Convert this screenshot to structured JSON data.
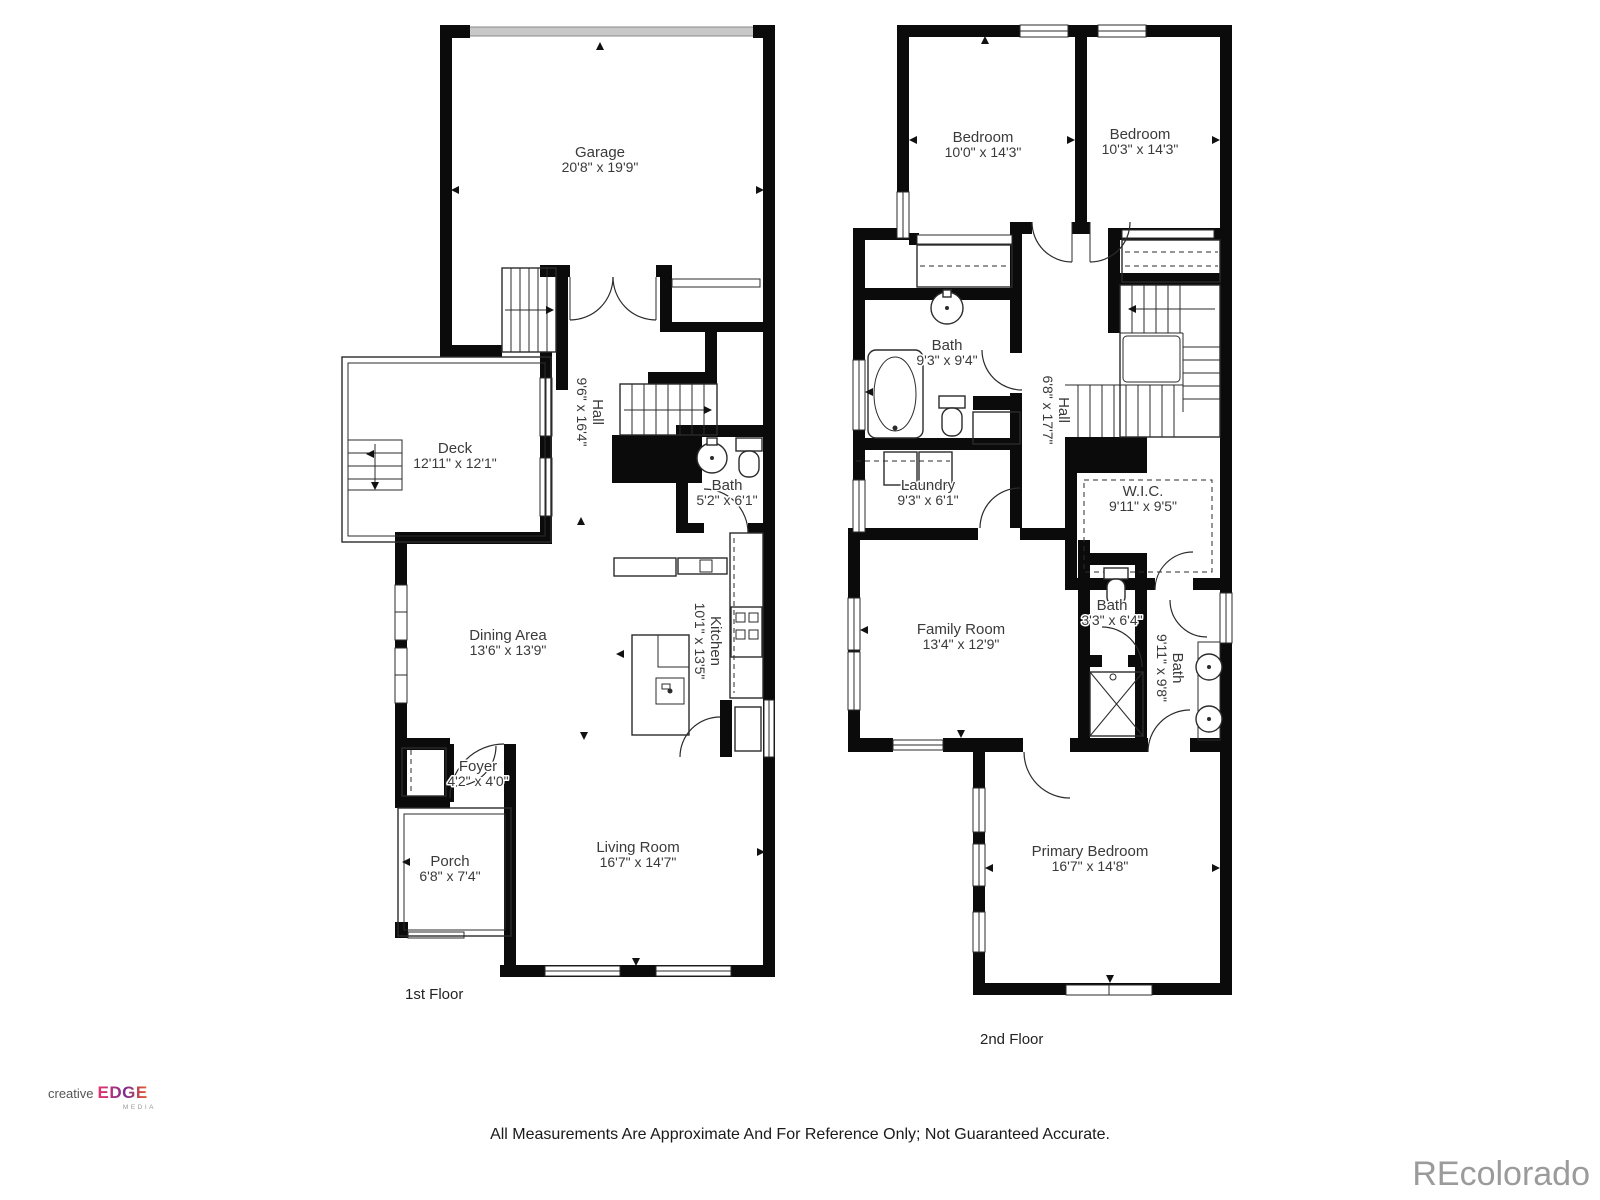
{
  "floors": [
    {
      "label": "1st Floor",
      "rooms": {
        "garage": {
          "name": "Garage",
          "dims": "20'8\" x 19'9\""
        },
        "hall": {
          "name": "Hall",
          "dims": "9'6\" x 16'4\""
        },
        "deck": {
          "name": "Deck",
          "dims": "12'11\" x 12'1\""
        },
        "bath": {
          "name": "Bath",
          "dims": "5'2\" x 6'1\""
        },
        "kitchen": {
          "name": "Kitchen",
          "dims": "10'1\" x 13'5\""
        },
        "dining": {
          "name": "Dining Area",
          "dims": "13'6\" x 13'9\""
        },
        "foyer": {
          "name": "Foyer",
          "dims": "4'2\" x 4'0\""
        },
        "porch": {
          "name": "Porch",
          "dims": "6'8\" x 7'4\""
        },
        "living": {
          "name": "Living Room",
          "dims": "16'7\" x 14'7\""
        }
      }
    },
    {
      "label": "2nd Floor",
      "rooms": {
        "bedroom_left": {
          "name": "Bedroom",
          "dims": "10'0\" x 14'3\""
        },
        "bedroom_right": {
          "name": "Bedroom",
          "dims": "10'3\" x 14'3\""
        },
        "bath_hall": {
          "name": "Bath",
          "dims": "9'3\" x 9'4\""
        },
        "hall": {
          "name": "Hall",
          "dims": "6'8\" x 17'7\""
        },
        "laundry": {
          "name": "Laundry",
          "dims": "9'3\" x 6'1\""
        },
        "wic": {
          "name": "W.I.C.",
          "dims": "9'11\" x 9'5\""
        },
        "family": {
          "name": "Family Room",
          "dims": "13'4\" x 12'9\""
        },
        "bath_small": {
          "name": "Bath",
          "dims": "3'3\" x 6'4\""
        },
        "bath_primary": {
          "name": "Bath",
          "dims": "9'11\" x 9'8\""
        },
        "primary": {
          "name": "Primary Bedroom",
          "dims": "16'7\" x 14'8\""
        }
      }
    }
  ],
  "footer": {
    "disclaimer": "All Measurements Are Approximate And For Reference Only; Not Guaranteed Accurate.",
    "watermark": "REcolorado",
    "logo": {
      "word": "creative",
      "brand": "EDGE",
      "sub": "MEDIA"
    }
  },
  "colors": {
    "wall": "#0b0b0b",
    "garage_door": "#c8c8c8",
    "label_text": "#3a3a3a",
    "watermark": "#9b9b9b",
    "logo_pink": "#e8336e",
    "logo_purple": "#7b2d8b",
    "logo_orange": "#f05a28"
  }
}
